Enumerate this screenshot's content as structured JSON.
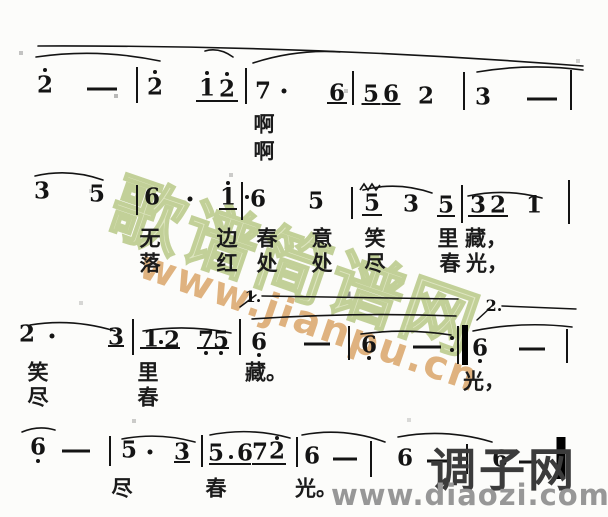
{
  "watermark_center": {
    "site_name": "歌谱简谱网",
    "site_url": "www.jianpu.cn",
    "name_color": "#dfe6c2",
    "url_color": "#dcab72"
  },
  "watermark_corner": {
    "site_name": "调子网",
    "site_url": "www.diaozi.com",
    "name_color": "#3b3b3b",
    "url_color": "#979797"
  },
  "score": {
    "notation_color": "#141414",
    "systems": [
      {
        "notes": [
          {
            "k": "n",
            "g": "2",
            "x": 45,
            "y": 85
          },
          {
            "k": "o",
            "x": 45,
            "y": 70
          },
          {
            "k": "d",
            "x": 102,
            "y": 89,
            "w": 30
          },
          {
            "k": "b",
            "x": 137,
            "y": 85,
            "h": 36
          },
          {
            "k": "n",
            "g": "2",
            "x": 155,
            "y": 87
          },
          {
            "k": "o",
            "x": 155,
            "y": 72
          },
          {
            "k": "n",
            "g": "1",
            "x": 207,
            "y": 88
          },
          {
            "k": "o",
            "x": 207,
            "y": 73
          },
          {
            "k": "n",
            "g": "2",
            "x": 227,
            "y": 89
          },
          {
            "k": "o",
            "x": 227,
            "y": 74
          },
          {
            "k": "u",
            "x": 217,
            "y": 101,
            "w": 42
          },
          {
            "k": "b",
            "x": 246,
            "y": 86,
            "h": 36
          },
          {
            "k": "n",
            "g": "7",
            "x": 263,
            "y": 91
          },
          {
            "k": "o",
            "x": 284,
            "y": 91,
            "s": 5
          },
          {
            "k": "n",
            "g": "6",
            "x": 337,
            "y": 93
          },
          {
            "k": "u",
            "x": 337,
            "y": 103,
            "w": 20
          },
          {
            "k": "b",
            "x": 353,
            "y": 88,
            "h": 34
          },
          {
            "k": "n",
            "g": "5",
            "x": 371,
            "y": 94
          },
          {
            "k": "u",
            "x": 371,
            "y": 104,
            "w": 19
          },
          {
            "k": "n",
            "g": "6",
            "x": 391,
            "y": 94
          },
          {
            "k": "u",
            "x": 391,
            "y": 104,
            "w": 19
          },
          {
            "k": "n",
            "g": "2",
            "x": 426,
            "y": 96
          },
          {
            "k": "b",
            "x": 464,
            "y": 91,
            "h": 38
          },
          {
            "k": "n",
            "g": "3",
            "x": 483,
            "y": 97
          },
          {
            "k": "d",
            "x": 542,
            "y": 99,
            "w": 30
          },
          {
            "k": "b",
            "x": 571,
            "y": 90,
            "h": 40
          }
        ],
        "lyrics": [
          {
            "y": 124,
            "cells": [
              {
                "t": "啊",
                "x": 264
              }
            ]
          },
          {
            "y": 151,
            "cells": [
              {
                "t": "啊",
                "x": 264
              }
            ]
          }
        ]
      },
      {
        "notes": [
          {
            "k": "n",
            "g": "3",
            "x": 42,
            "y": 191
          },
          {
            "k": "n",
            "g": "5",
            "x": 97,
            "y": 194
          },
          {
            "k": "b",
            "x": 137,
            "y": 200,
            "h": 30
          },
          {
            "k": "n",
            "g": "6",
            "x": 152,
            "y": 197
          },
          {
            "k": "o",
            "x": 190,
            "y": 199,
            "s": 5
          },
          {
            "k": "n",
            "g": "1",
            "x": 228,
            "y": 197
          },
          {
            "k": "o",
            "x": 228,
            "y": 183
          },
          {
            "k": "u",
            "x": 228,
            "y": 209,
            "w": 18
          },
          {
            "k": "b",
            "x": 242,
            "y": 201,
            "h": 38
          },
          {
            "k": "o",
            "x": 247,
            "y": 197,
            "s": 4
          },
          {
            "k": "n",
            "g": "6",
            "x": 258,
            "y": 199
          },
          {
            "k": "n",
            "g": "5",
            "x": 316,
            "y": 201
          },
          {
            "k": "b",
            "x": 352,
            "y": 203,
            "h": 32
          },
          {
            "k": "m",
            "x": 370,
            "y": 187
          },
          {
            "k": "n",
            "g": "5",
            "x": 372,
            "y": 203
          },
          {
            "k": "u",
            "x": 372,
            "y": 215,
            "w": 20
          },
          {
            "k": "n",
            "g": "3",
            "x": 411,
            "y": 204
          },
          {
            "k": "n",
            "g": "5",
            "x": 446,
            "y": 205
          },
          {
            "k": "u",
            "x": 446,
            "y": 216,
            "w": 18
          },
          {
            "k": "b",
            "x": 462,
            "y": 204,
            "h": 38
          },
          {
            "k": "n",
            "g": "3",
            "x": 478,
            "y": 205
          },
          {
            "k": "n",
            "g": "2",
            "x": 498,
            "y": 205
          },
          {
            "k": "u",
            "x": 488,
            "y": 216,
            "w": 40
          },
          {
            "k": "n",
            "g": "1",
            "x": 534,
            "y": 205
          },
          {
            "k": "b",
            "x": 569,
            "y": 202,
            "h": 44
          }
        ],
        "lyrics": [
          {
            "y": 238,
            "cells": [
              {
                "t": "无",
                "x": 150
              },
              {
                "t": "边",
                "x": 227
              },
              {
                "t": "春",
                "x": 267
              },
              {
                "t": "意",
                "x": 322
              },
              {
                "t": "笑",
                "x": 375
              },
              {
                "t": "里",
                "x": 448
              },
              {
                "t": "藏，",
                "x": 486
              }
            ]
          },
          {
            "y": 263,
            "cells": [
              {
                "t": "落",
                "x": 150
              },
              {
                "t": "红",
                "x": 227
              },
              {
                "t": "处",
                "x": 267
              },
              {
                "t": "处",
                "x": 322
              },
              {
                "t": "尽",
                "x": 375
              },
              {
                "t": "春",
                "x": 450
              },
              {
                "t": "光，",
                "x": 487
              }
            ]
          }
        ]
      },
      {
        "notes": [
          {
            "k": "n",
            "g": "2",
            "x": 27,
            "y": 334
          },
          {
            "k": "o",
            "x": 52,
            "y": 336,
            "s": 5
          },
          {
            "k": "n",
            "g": "3",
            "x": 116,
            "y": 337
          },
          {
            "k": "u",
            "x": 116,
            "y": 346,
            "w": 16
          },
          {
            "k": "b",
            "x": 133,
            "y": 337,
            "h": 36
          },
          {
            "k": "n",
            "g": "1",
            "x": 151,
            "y": 339
          },
          {
            "k": "o",
            "x": 161,
            "y": 342,
            "s": 4
          },
          {
            "k": "n",
            "g": "2",
            "x": 172,
            "y": 340
          },
          {
            "k": "u",
            "x": 160,
            "y": 348,
            "w": 40
          },
          {
            "k": "n",
            "g": "7",
            "x": 206,
            "y": 340
          },
          {
            "k": "o",
            "x": 206,
            "y": 353
          },
          {
            "k": "n",
            "g": "5",
            "x": 221,
            "y": 340
          },
          {
            "k": "o",
            "x": 221,
            "y": 353
          },
          {
            "k": "u",
            "x": 213,
            "y": 348,
            "w": 32
          },
          {
            "k": "b",
            "x": 240,
            "y": 337,
            "h": 36
          },
          {
            "k": "n",
            "g": "6",
            "x": 259,
            "y": 342
          },
          {
            "k": "o",
            "x": 259,
            "y": 355
          },
          {
            "k": "d",
            "x": 317,
            "y": 344,
            "w": 26
          },
          {
            "k": "b",
            "x": 349,
            "y": 343,
            "h": 34
          },
          {
            "k": "n",
            "g": "6",
            "x": 369,
            "y": 345
          },
          {
            "k": "o",
            "x": 369,
            "y": 358
          },
          {
            "k": "d",
            "x": 427,
            "y": 347,
            "w": 28
          },
          {
            "k": "o",
            "x": 452,
            "y": 338,
            "s": 4
          },
          {
            "k": "o",
            "x": 452,
            "y": 350,
            "s": 4
          },
          {
            "k": "b",
            "x": 458,
            "y": 345,
            "h": 38
          },
          {
            "k": "t",
            "x": 465,
            "y": 345,
            "h": 40,
            "w": 6
          },
          {
            "k": "n",
            "g": "6",
            "x": 480,
            "y": 348
          },
          {
            "k": "o",
            "x": 480,
            "y": 361
          },
          {
            "k": "d",
            "x": 532,
            "y": 349,
            "w": 26
          },
          {
            "k": "b",
            "x": 567,
            "y": 346,
            "h": 34
          }
        ],
        "lyrics": [
          {
            "y": 372,
            "cells": [
              {
                "t": "笑",
                "x": 38
              },
              {
                "t": "里",
                "x": 148
              },
              {
                "t": "藏。",
                "x": 266
              }
            ]
          },
          {
            "y": 381,
            "cells": [
              {
                "t": "光，",
                "x": 484
              }
            ]
          },
          {
            "y": 397,
            "cells": [
              {
                "t": "尽",
                "x": 38
              },
              {
                "t": "春",
                "x": 148
              }
            ]
          }
        ]
      },
      {
        "notes": [
          {
            "k": "n",
            "g": "6",
            "x": 38,
            "y": 447
          },
          {
            "k": "o",
            "x": 38,
            "y": 461
          },
          {
            "k": "d",
            "x": 76,
            "y": 451,
            "w": 28
          },
          {
            "k": "b",
            "x": 110,
            "y": 451,
            "h": 30
          },
          {
            "k": "n",
            "g": "5",
            "x": 129,
            "y": 450
          },
          {
            "k": "o",
            "x": 150,
            "y": 452,
            "s": 5
          },
          {
            "k": "n",
            "g": "3",
            "x": 182,
            "y": 452
          },
          {
            "k": "u",
            "x": 182,
            "y": 462,
            "w": 16
          },
          {
            "k": "b",
            "x": 202,
            "y": 451,
            "h": 32
          },
          {
            "k": "n",
            "g": "5",
            "x": 216,
            "y": 453
          },
          {
            "k": "o",
            "x": 231,
            "y": 457,
            "s": 4
          },
          {
            "k": "n",
            "g": "6",
            "x": 245,
            "y": 453
          },
          {
            "k": "u",
            "x": 230,
            "y": 464,
            "w": 42
          },
          {
            "k": "n",
            "g": "7",
            "x": 260,
            "y": 452
          },
          {
            "k": "n",
            "g": "2",
            "x": 277,
            "y": 451
          },
          {
            "k": "o",
            "x": 277,
            "y": 438
          },
          {
            "k": "u",
            "x": 269,
            "y": 464,
            "w": 34
          },
          {
            "k": "b",
            "x": 297,
            "y": 452,
            "h": 30
          },
          {
            "k": "n",
            "g": "6",
            "x": 312,
            "y": 456
          },
          {
            "k": "d",
            "x": 345,
            "y": 459,
            "w": 24
          },
          {
            "k": "b",
            "x": 371,
            "y": 459,
            "h": 36
          },
          {
            "k": "n",
            "g": "6",
            "x": 405,
            "y": 458
          },
          {
            "k": "d",
            "x": 438,
            "y": 461,
            "w": 22
          },
          {
            "k": "b",
            "x": 467,
            "y": 459,
            "h": 30
          },
          {
            "k": "n",
            "g": "6",
            "x": 500,
            "y": 459
          },
          {
            "k": "d",
            "x": 528,
            "y": 462,
            "w": 18
          },
          {
            "k": "t",
            "x": 561,
            "y": 458,
            "h": 42,
            "w": 9
          }
        ],
        "lyrics": [
          {
            "y": 488,
            "cells": [
              {
                "t": "尽",
                "x": 122
              },
              {
                "t": "春",
                "x": 216
              },
              {
                "t": "光。",
                "x": 316
              }
            ]
          }
        ]
      }
    ],
    "arcs": [
      {
        "x1": 38,
        "y1": 46,
        "x2": 583,
        "y2": 66,
        "bow": 1
      },
      {
        "x1": 36,
        "y1": 57,
        "x2": 160,
        "y2": 61,
        "bow": 9
      },
      {
        "x1": 205,
        "y1": 51,
        "x2": 233,
        "y2": 57,
        "bow": 4
      },
      {
        "x1": 253,
        "y1": 63,
        "x2": 340,
        "y2": 52,
        "bow": 3
      },
      {
        "x1": 477,
        "y1": 72,
        "x2": 583,
        "y2": 70,
        "bow": 7
      },
      {
        "x1": 35,
        "y1": 176,
        "x2": 103,
        "y2": 180,
        "bow": 8
      },
      {
        "x1": 363,
        "y1": 190,
        "x2": 432,
        "y2": 193,
        "bow": 9
      },
      {
        "x1": 468,
        "y1": 196,
        "x2": 542,
        "y2": 198,
        "bow": 8
      },
      {
        "x1": 30,
        "y1": 325,
        "x2": 115,
        "y2": 331,
        "bow": 7
      },
      {
        "x1": 143,
        "y1": 331,
        "x2": 231,
        "y2": 333,
        "bow": 7
      },
      {
        "x1": 252,
        "y1": 319,
        "x2": 456,
        "y2": 316,
        "bow": 4
      },
      {
        "x1": 361,
        "y1": 334,
        "x2": 451,
        "y2": 335,
        "bow": 6
      },
      {
        "x1": 473,
        "y1": 331,
        "x2": 572,
        "y2": 327,
        "bow": 6
      },
      {
        "x1": 22,
        "y1": 432,
        "x2": 55,
        "y2": 430,
        "bow": 5
      },
      {
        "x1": 122,
        "y1": 439,
        "x2": 195,
        "y2": 442,
        "bow": 7
      },
      {
        "x1": 210,
        "y1": 435,
        "x2": 290,
        "y2": 438,
        "bow": 8
      },
      {
        "x1": 302,
        "y1": 435,
        "x2": 385,
        "y2": 442,
        "bow": 8
      },
      {
        "x1": 398,
        "y1": 437,
        "x2": 492,
        "y2": 442,
        "bow": 9
      }
    ],
    "voltas": [
      {
        "label": "1.",
        "x": 253,
        "y": 297,
        "line": {
          "x1": 262,
          "y1": 296,
          "x2": 458,
          "y2": 299
        },
        "tick": {
          "x1": 240,
          "y1": 307,
          "x2": 256,
          "y2": 295
        }
      },
      {
        "label": "2.",
        "x": 494,
        "y": 306,
        "line": {
          "x1": 502,
          "y1": 306,
          "x2": 576,
          "y2": 309
        },
        "tick": {
          "x1": 477,
          "y1": 320,
          "x2": 490,
          "y2": 308
        }
      }
    ]
  }
}
